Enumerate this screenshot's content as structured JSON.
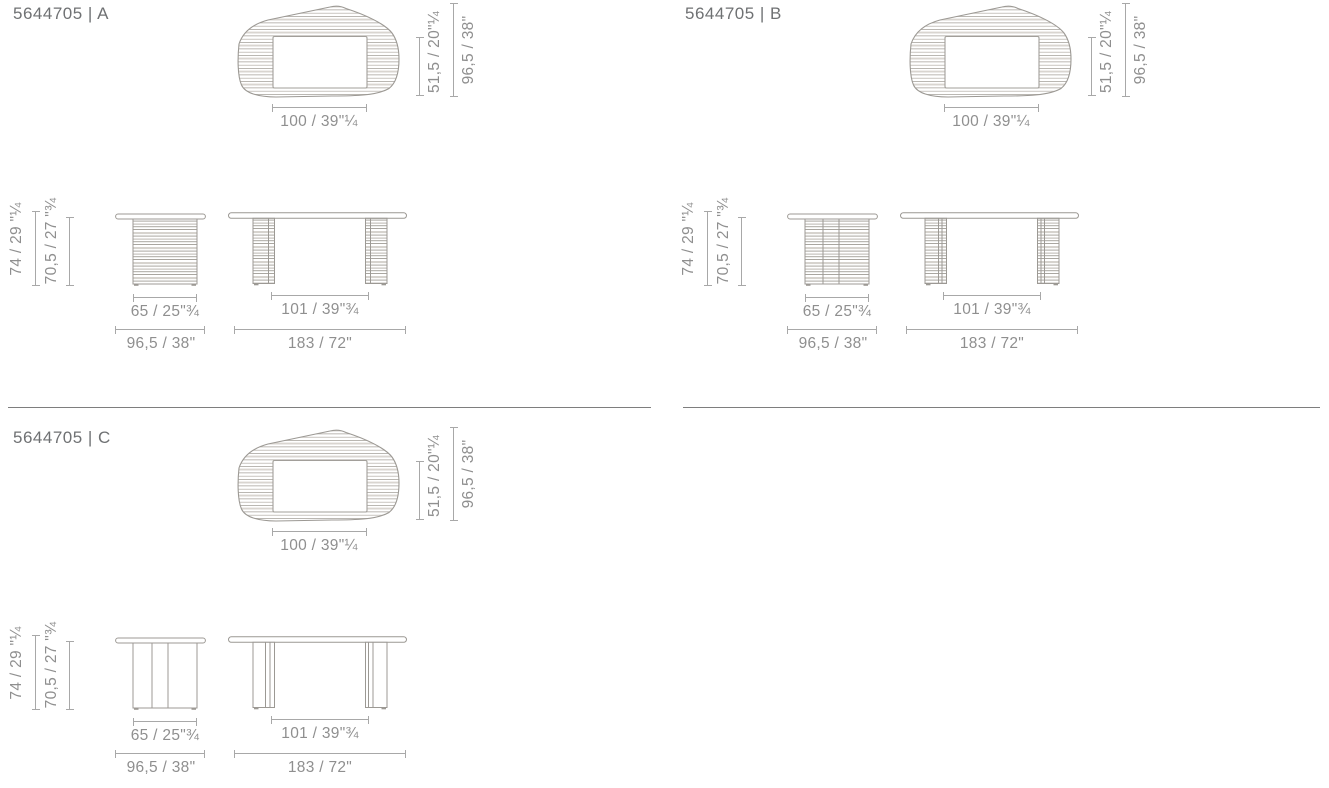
{
  "colors": {
    "background": "#ffffff",
    "title_text": "#6f7173",
    "dimension_text": "#8f8f8f",
    "outline": "#9c9994",
    "hatch": "#b2aea8",
    "dimension_line": "#a8a8a8",
    "divider": "#7e7e7e"
  },
  "sections": [
    {
      "code": "5644705 | A",
      "top_view": {
        "inset_depth": "51,5 / 20\"¼",
        "total_depth": "96,5 / 38\"",
        "width": "100 / 39\"¼"
      },
      "side_view": {
        "total_height": "74 / 29 \"¼",
        "base_height": "70,5 / 27 \"¾",
        "base_width": "65 / 25\"¾",
        "depth": "96,5 / 38\""
      },
      "front_view": {
        "leg_span": "101 / 39\"¾",
        "width": "183 / 72\""
      }
    },
    {
      "code": "5644705 | B",
      "top_view": {
        "inset_depth": "51,5 / 20\"¼",
        "total_depth": "96,5 / 38\"",
        "width": "100 / 39\"¼"
      },
      "side_view": {
        "total_height": "74 / 29 \"¼",
        "base_height": "70,5 / 27 \"¾",
        "base_width": "65 / 25\"¾",
        "depth": "96,5 / 38\""
      },
      "front_view": {
        "leg_span": "101 / 39\"¾",
        "width": "183 / 72\""
      }
    },
    {
      "code": "5644705 | C",
      "top_view": {
        "inset_depth": "51,5 / 20\"¼",
        "total_depth": "96,5 / 38\"",
        "width": "100 / 39\"¼"
      },
      "side_view": {
        "total_height": "74 / 29 \"¼",
        "base_height": "70,5 / 27 \"¾",
        "base_width": "65 / 25\"¾",
        "depth": "96,5 / 38\""
      },
      "front_view": {
        "leg_span": "101 / 39\"¾",
        "width": "183 / 72\""
      }
    }
  ]
}
